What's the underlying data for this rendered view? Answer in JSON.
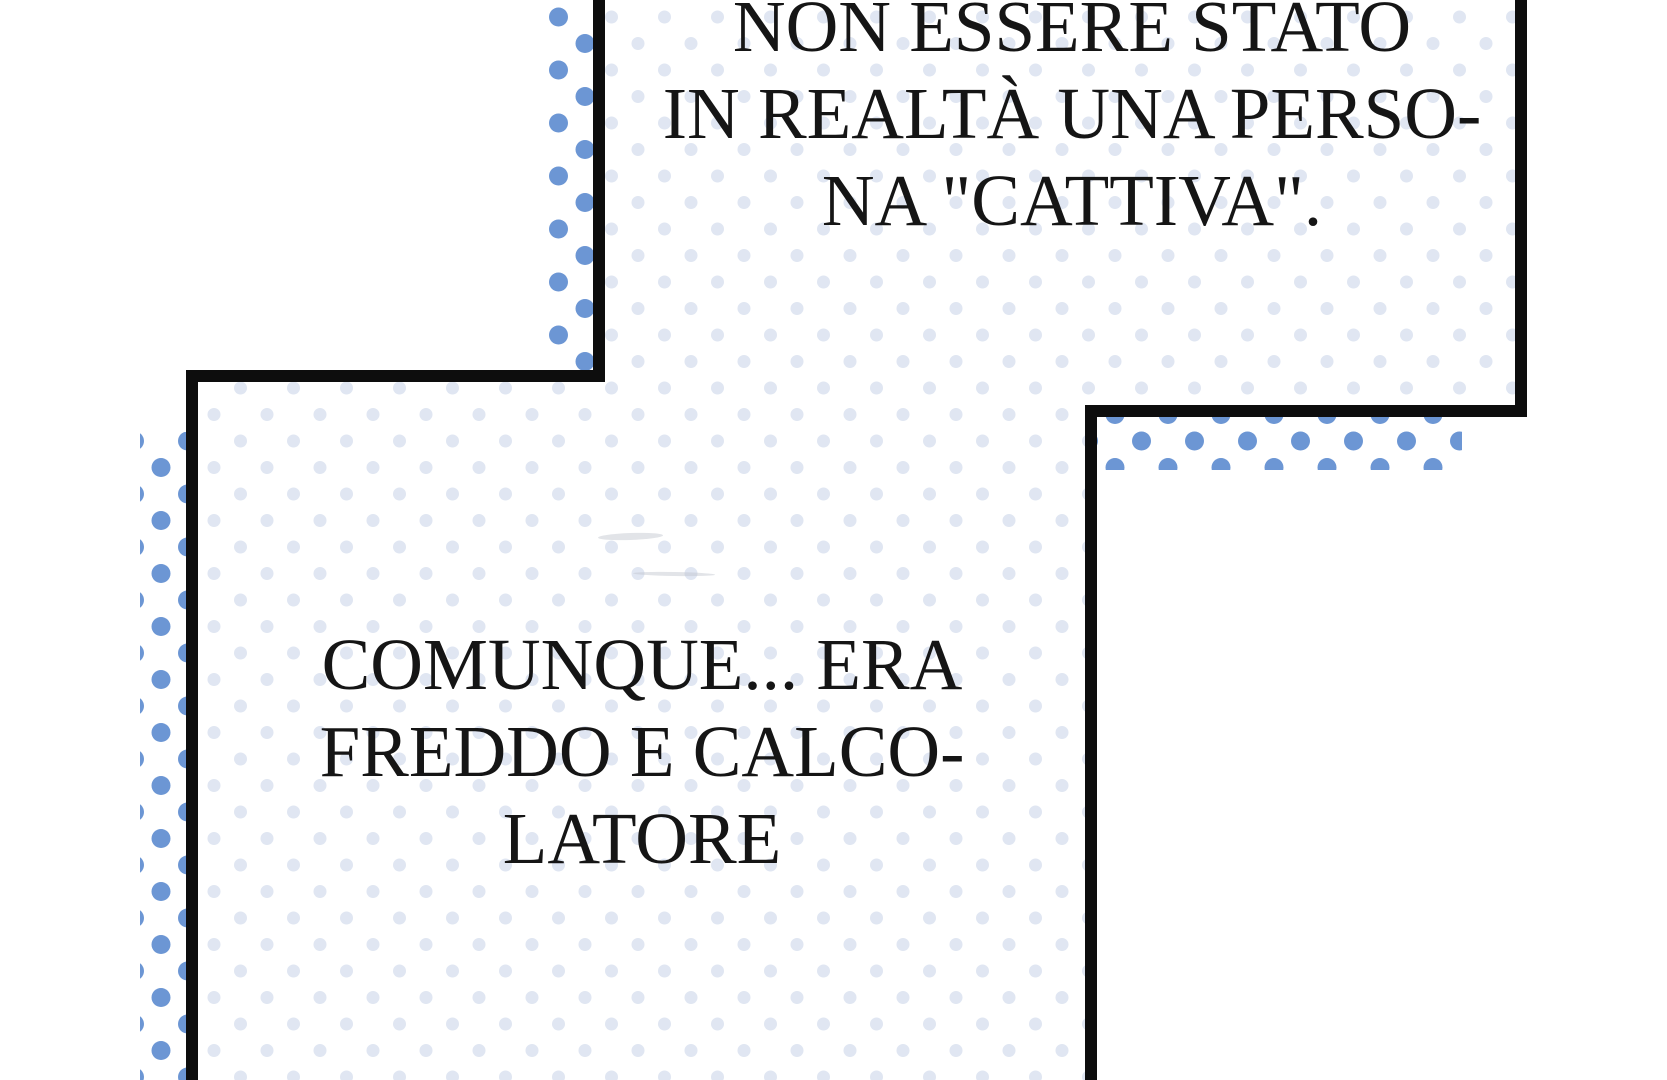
{
  "comic": {
    "panels": [
      {
        "position": "top-right",
        "dialogue_lines": [
          "NON ESSERE STATO",
          "IN REALTÀ UNA PERSO-",
          "NA \"CATTIVA\"."
        ]
      },
      {
        "position": "bottom-left",
        "dialogue_lines": [
          "COMUNQUE... ERA",
          "FREDDO E CALCO-",
          "LATORE"
        ]
      }
    ]
  },
  "colors": {
    "background": "#ffffff",
    "panel_border": "#0d0d0d",
    "halftone_strong_blue": "#6c96d4",
    "halftone_faint_blue": "#e0e6f2",
    "text": "#151515"
  }
}
